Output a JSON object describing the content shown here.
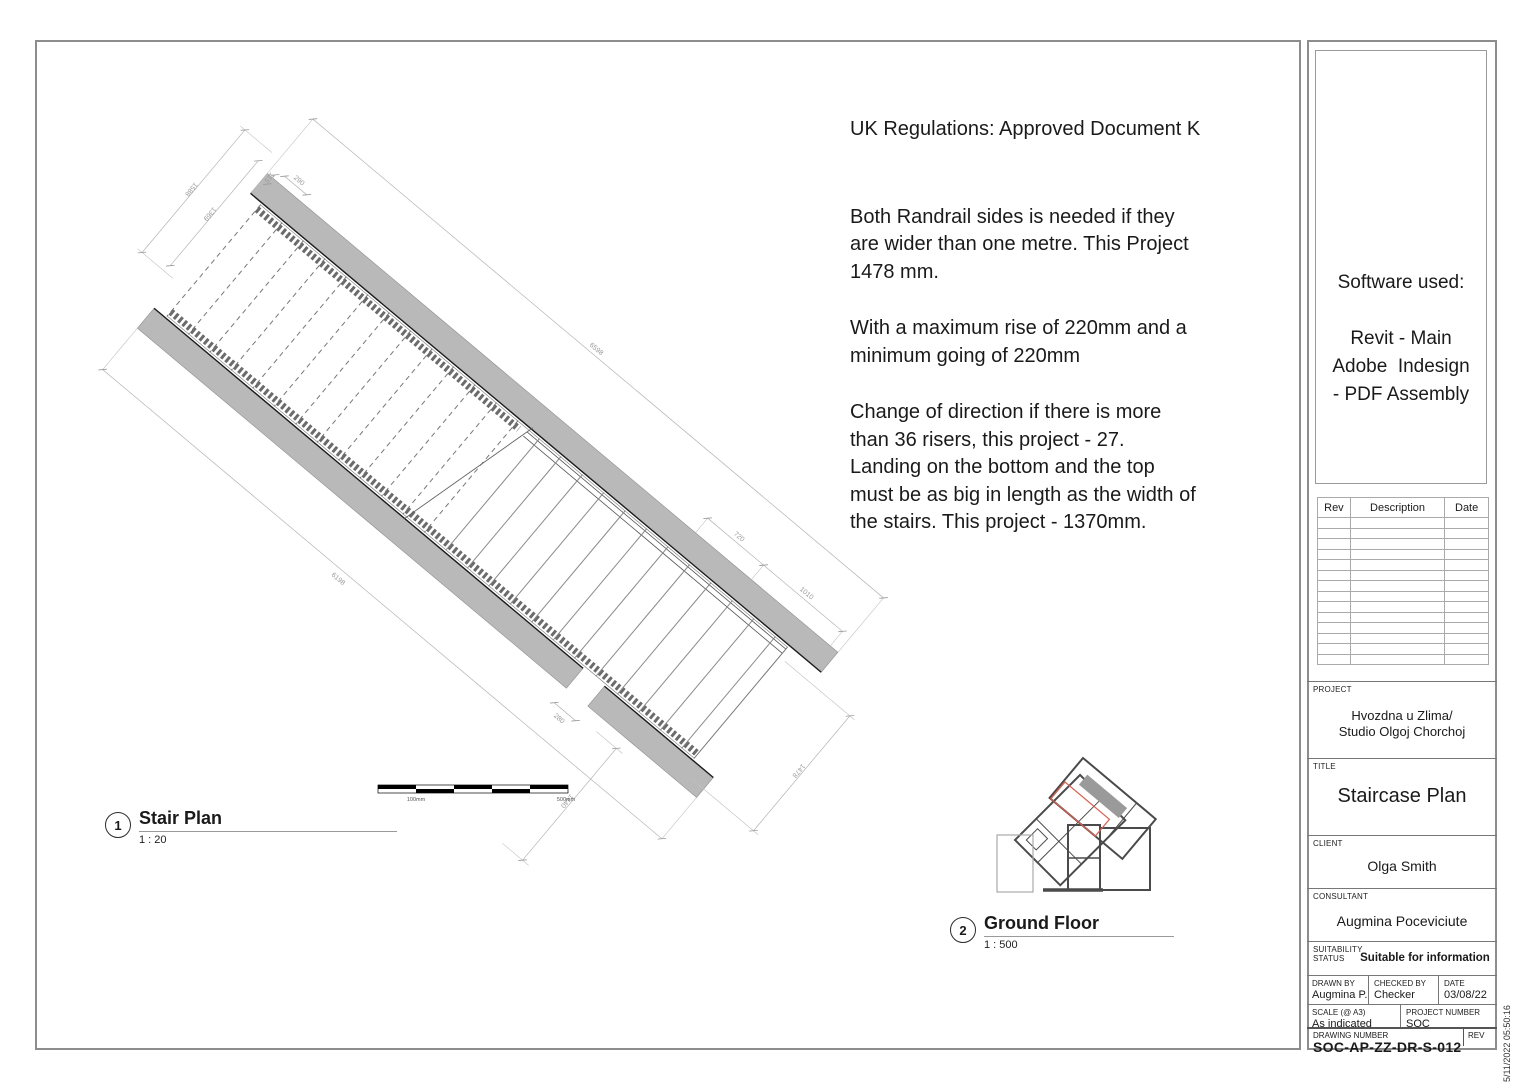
{
  "annotations": {
    "heading": "UK Regulations: Approved Document K",
    "paragraphs": [
      "Both Randrail sides is needed if they\nare wider than one metre. This Project\n1478 mm.",
      "With a maximum rise of 220mm and a\nminimum going of 220mm",
      "Change of direction if there is more\nthan 36 risers, this project - 27.\nLanding on the bottom and the top\nmust be as big in length as the width of\nthe stairs. This project -  1370mm."
    ]
  },
  "views": [
    {
      "number": "1",
      "title": "Stair Plan",
      "scale": "1 : 20"
    },
    {
      "number": "2",
      "title": "Ground Floor",
      "scale": "1 : 500"
    }
  ],
  "stair_plan": {
    "dimensions": {
      "top_landing_a": "1588",
      "top_landing_b": "1369",
      "nib": "115",
      "wall_offset": "290",
      "flight_upper_total": "6598",
      "run_a": "720",
      "run_b": "1010",
      "flight_lower_total": "6198",
      "opening_gap": "280",
      "landing_width": "1440",
      "stair_width": "1478"
    }
  },
  "scale_bar": {
    "label_left": "100mm",
    "label_right": "500mm"
  },
  "software_box": {
    "text": "Software used:\n\nRevit - Main\nAdobe  Indesign\n- PDF Assembly"
  },
  "revision_table": {
    "headers": [
      "Rev",
      "Description",
      "Date"
    ],
    "empty_row_count": 14
  },
  "title_block": {
    "project_label": "PROJECT",
    "project": "Hvozdna u Zlima/\nStudio Olgoj Chorchoj",
    "title_label": "TITLE",
    "title": "Staircase Plan",
    "client_label": "CLIENT",
    "client": "Olga Smith",
    "consultant_label": "CONSULTANT",
    "consultant": "Augmina Poceviciute",
    "suitability_label": "SUITABILITY\nSTATUS",
    "suitability": "Suitable for information",
    "drawn_by_label": "DRAWN BY",
    "drawn_by": "Augmina P.",
    "checked_by_label": "CHECKED BY",
    "checked_by": "Checker",
    "date_label": "DATE",
    "date": "03/08/22",
    "scale_label": "SCALE (@ A3)",
    "scale": "As indicated",
    "project_number_label": "PROJECT NUMBER",
    "project_number": "SOC",
    "drawing_number_label": "DRAWING NUMBER",
    "drawing_number": "SOC-AP-ZZ-DR-S-012",
    "rev_label": "REV"
  },
  "timestamp": "5/11/2022 05:50:16"
}
